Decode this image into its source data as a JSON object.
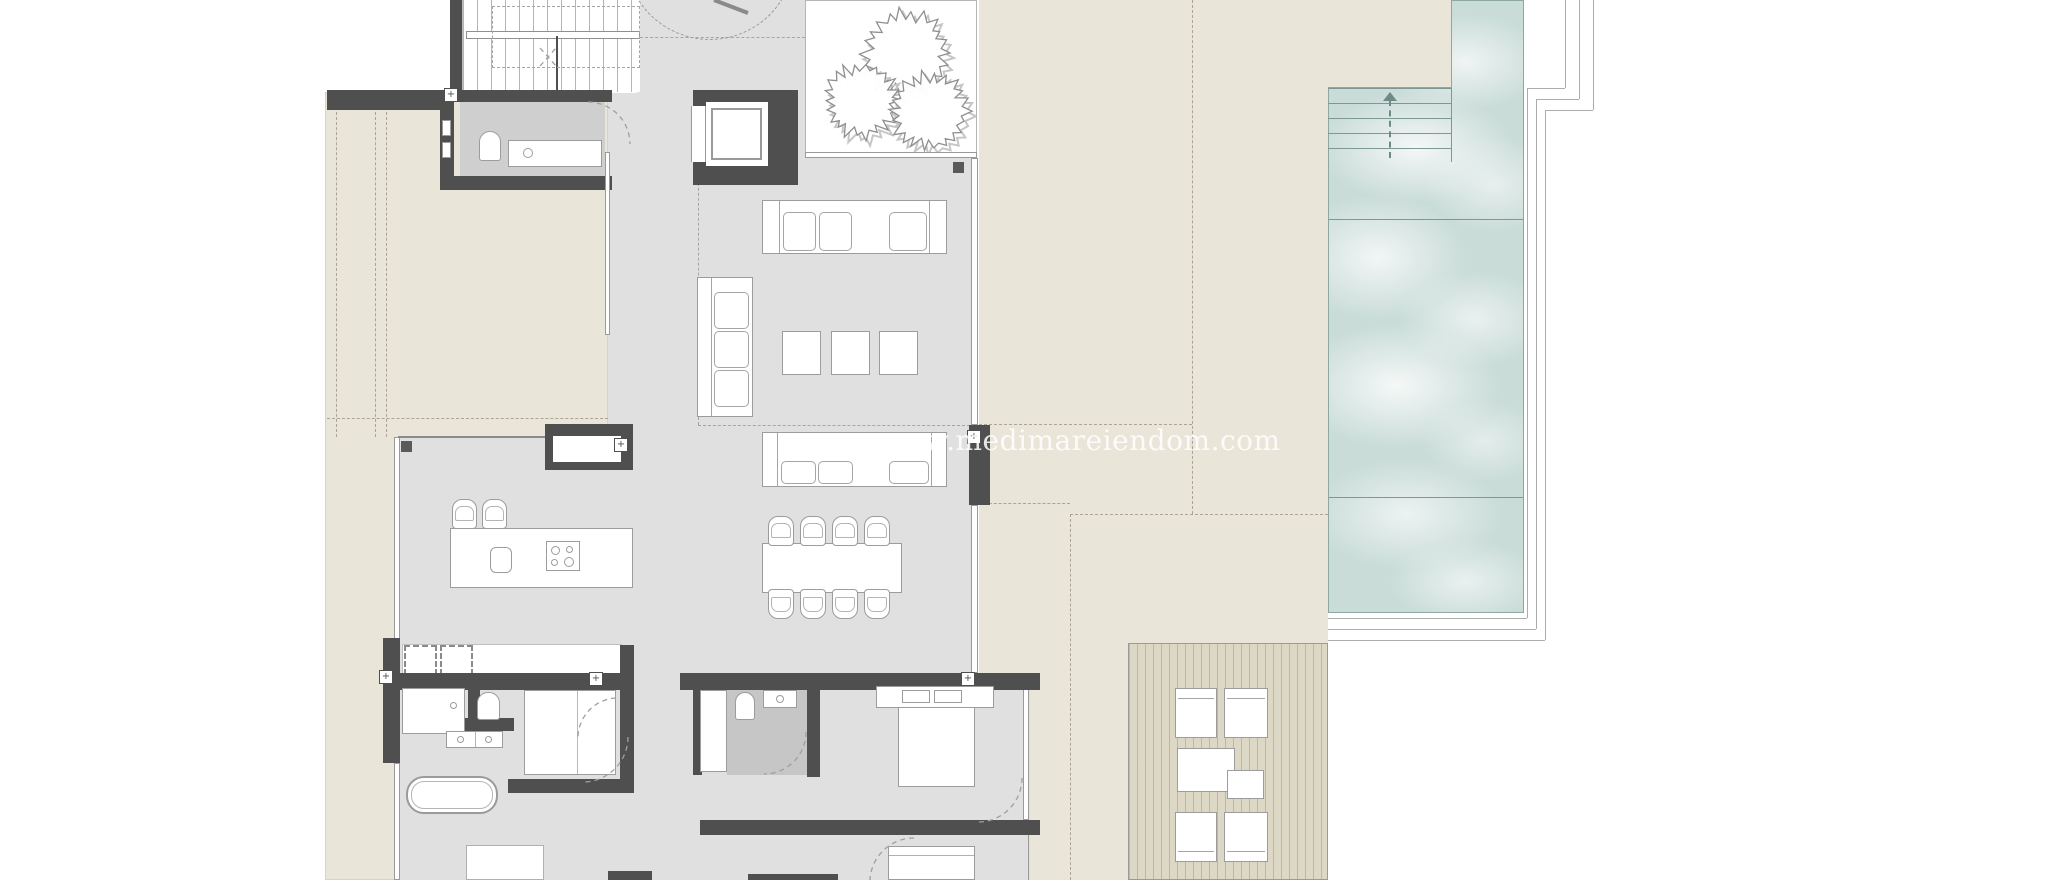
{
  "watermark": {
    "text": "www.medimareiendom.com"
  },
  "palette": {
    "white": "#ffffff",
    "beige": "#e9e5d8",
    "floor": "#e0e0e0",
    "floor_dark": "#cfcfcf",
    "floor_darker": "#c6c6c6",
    "wall": "#4f4f4f",
    "line": "#9c9c9c",
    "dash": "#aba394",
    "pool": "#c9dcd8",
    "pool_edge": "#8fa7a3",
    "pool_line": "#7e9894",
    "deck": "#ddd7c6",
    "frame": "#a9aeab"
  },
  "plan": {
    "type": "villa-floor-plan",
    "elements": [
      "staircase",
      "elevator",
      "planter-trees",
      "guest-wc-toilet",
      "guest-wc-washbasin",
      "sofa-top",
      "sofa-left",
      "sofa-bottom",
      "coffee-tables",
      "dining-table",
      "dining-chairs",
      "kitchen-island",
      "bar-stools",
      "kitchen-sink",
      "cooktop",
      "built-in-cabinet",
      "bathtub",
      "shower",
      "double-washbasin",
      "wc-toilet",
      "wardrobe",
      "appliance-niches",
      "ensuite-shower",
      "ensuite-toilet",
      "ensuite-washbasin",
      "double-bed",
      "second-bed",
      "door-swings",
      "property-boundary-dashed-lines",
      "terrace",
      "swimming-pool",
      "pool-steps",
      "pool-surround-frames",
      "sun-deck",
      "sun-loungers",
      "deck-side-tables"
    ]
  }
}
